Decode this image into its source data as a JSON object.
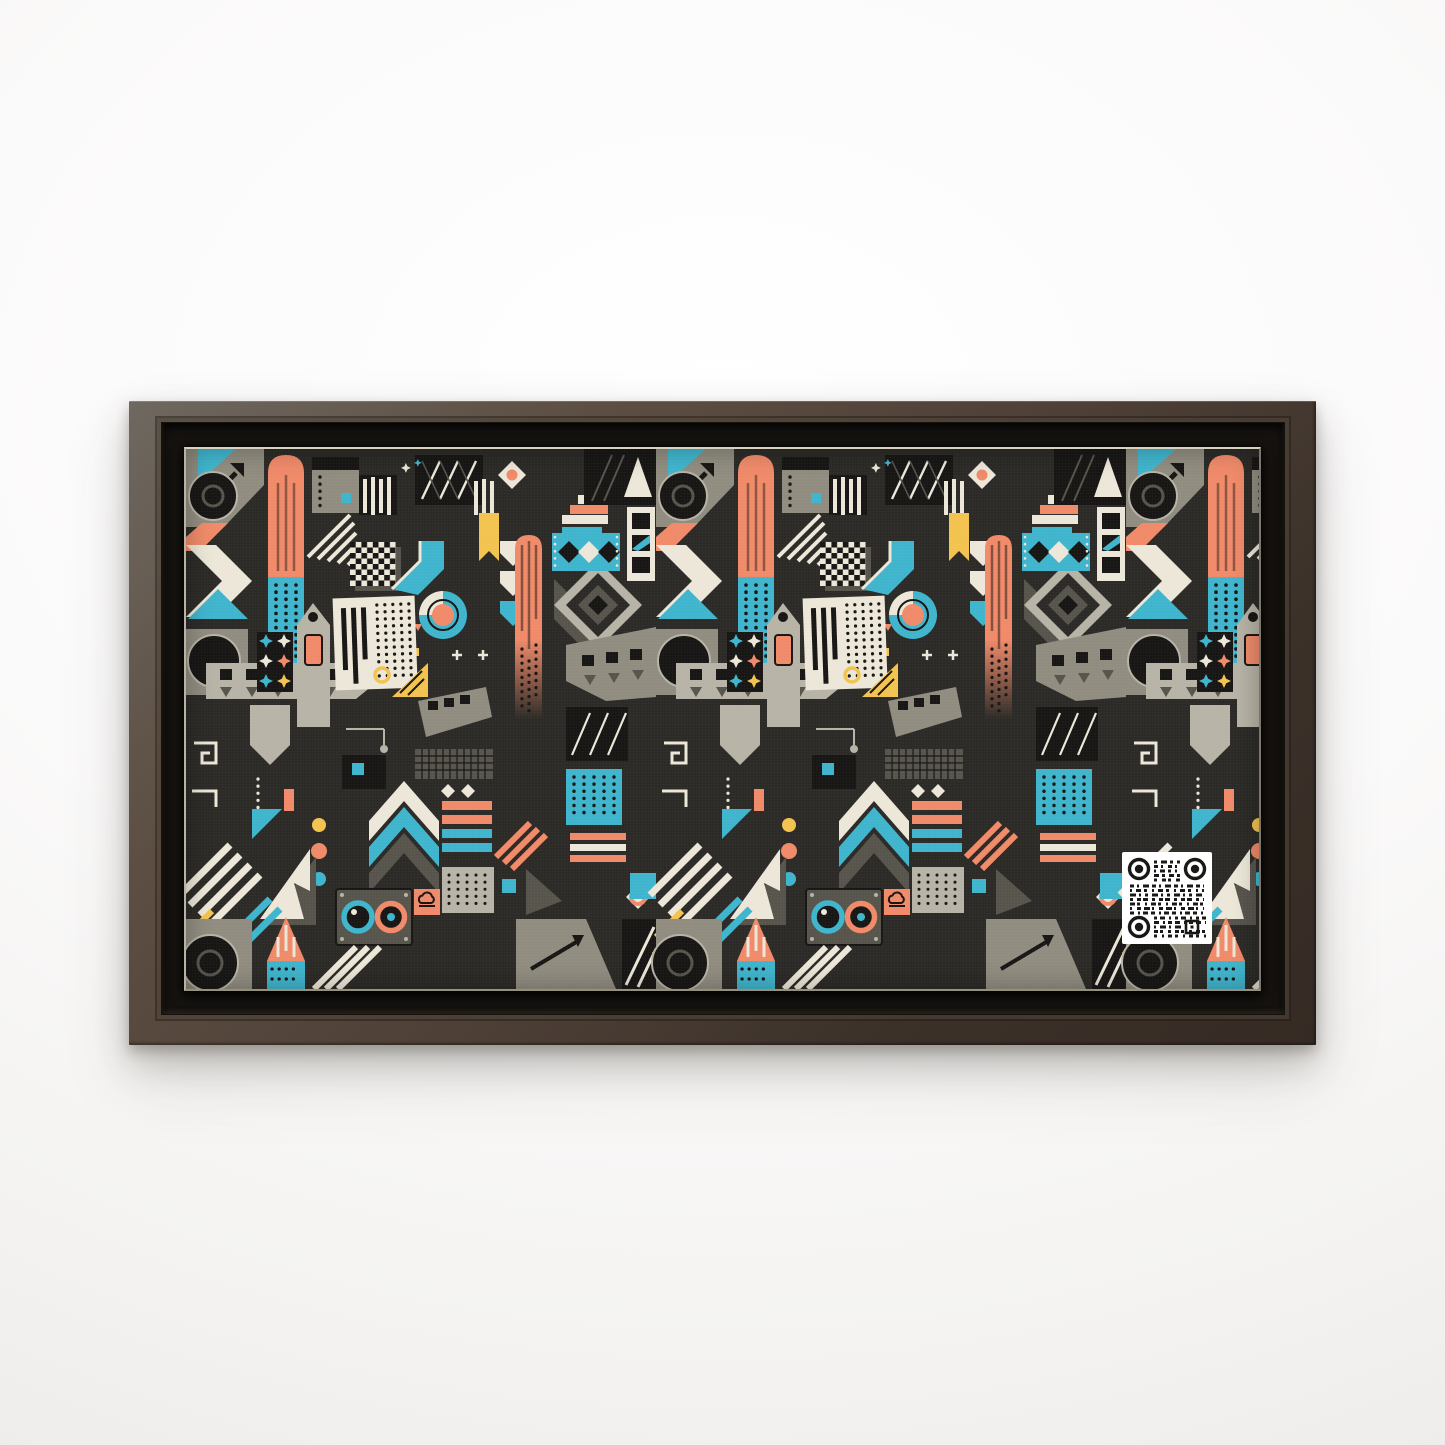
{
  "window": {
    "width": 1445,
    "height": 1445
  },
  "scene": {
    "type": "framed-canvas-wall-art-product-mockup",
    "wall": "plain white studio wall",
    "frame": {
      "style": "matte espresso floating frame",
      "material": "wood",
      "orientation": "horizontal",
      "aspect": "2:1"
    },
    "canvas": {
      "art_style": "retro geometric abstract pattern",
      "background": "dark charcoal"
    },
    "qr_overlay": {
      "present": true,
      "location": "lower right quadrant of artwork",
      "finder_style": "round rings",
      "module_color": "black on white"
    }
  },
  "palette": {
    "wall": "#f4f3f1",
    "framelight": "#6e6860",
    "framemid": "#4e4037",
    "framedark": "#352b24",
    "floater": "#15120f",
    "canvasedge": "#d8d2c2",
    "ink": "#2b2a26",
    "nearblack": "#171614",
    "teal": "#3fb5cd",
    "coral": "#f08a69",
    "yellow": "#f3c34f",
    "cream": "#ece7d8",
    "grayl": "#b7b3a6",
    "graym": "#908c80",
    "grayd": "#57544c",
    "qrwhite": "#ffffff"
  },
  "artwork": {
    "motifs": [
      "striped rocket bars (coral top, dotted teal bottom)",
      "black-and-cream chevrons with teal triangles",
      "film-strip arrow bands with squares and triangles",
      "large dark speaker circles on gray blocks",
      "checkerboard squares",
      "cream halftone-dot panels with black bars",
      "teal-cream-coral donut ring",
      "bowtie star tiles (teal, cream, coral, yellow)",
      "tall gray pencil house with coral window",
      "diagonal stripe bands",
      "staircase steps",
      "yellow ribbon bookmark",
      "teal banner with diamonds",
      "concentric gray diamonds",
      "cursor arrow triangles",
      "camera lens panel (teal and coral lenses)",
      "coral cloud-icon square",
      "three dots column (yellow, coral, teal)",
      "chevron mountains",
      "greek-key maze lines",
      "teal dotted square",
      "qr-code"
    ]
  }
}
